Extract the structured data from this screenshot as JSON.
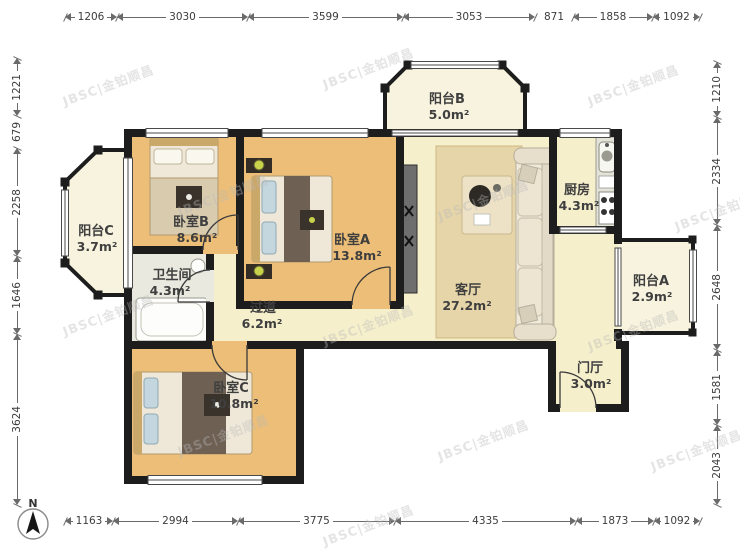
{
  "watermark": {
    "text": "JBSC|金铂顺昌"
  },
  "compass": {
    "label": "N"
  },
  "palette": {
    "wall": "#1d1d1d",
    "floor_wood": "#ECBE77",
    "floor_cream": "#F6EFCC",
    "floor_balcony": "#F7F3DE",
    "floor_gray": "#E9E9DF",
    "dim": "#3c3c3c",
    "label": "#3f3f3f",
    "watermark": "#b9b9b9"
  },
  "dimensions": {
    "top": [
      "1206",
      "3030",
      "3599",
      "3053",
      "871",
      "1858",
      "1092"
    ],
    "bottom": [
      "1163",
      "2994",
      "3775",
      "4335",
      "1873",
      "1092"
    ],
    "left": [
      "1221",
      "679",
      "2258",
      "1646",
      "3624"
    ],
    "right": [
      "1210",
      "2334",
      "2648",
      "1581",
      "2043"
    ]
  },
  "rooms": [
    {
      "name": "阳台B",
      "area": "5.0m²"
    },
    {
      "name": "厨房",
      "area": "4.3m²"
    },
    {
      "name": "阳台C",
      "area": "3.7m²"
    },
    {
      "name": "卧室B",
      "area": "8.6m²"
    },
    {
      "name": "卫生间",
      "area": "4.3m²"
    },
    {
      "name": "卧室A",
      "area": "13.8m²"
    },
    {
      "name": "过道",
      "area": "6.2m²"
    },
    {
      "name": "客厅",
      "area": "27.2m²"
    },
    {
      "name": "阳台A",
      "area": "2.9m²"
    },
    {
      "name": "卧室C",
      "area": "10.8m²"
    },
    {
      "name": "门厅",
      "area": "3.0m²"
    }
  ]
}
